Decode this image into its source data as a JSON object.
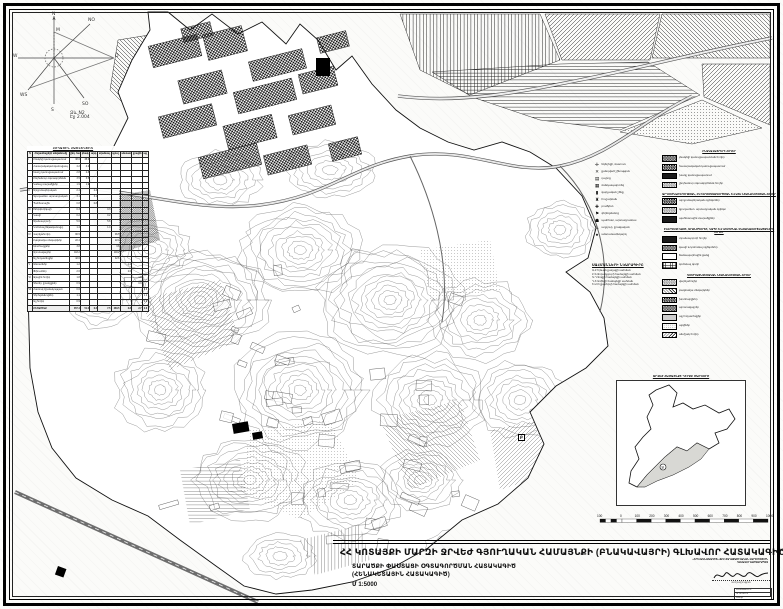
{
  "page": {
    "bg": "#fbfbf9",
    "ink": "#111111",
    "accent_gray": "#cfcfcf"
  },
  "compass": {
    "labels": {
      "n": "N",
      "m": "M",
      "no": "NO",
      "o": "O",
      "w": "W",
      "ws": "WS",
      "s": "S",
      "so": "SO"
    },
    "note_line1": "Ձև N2",
    "note_line2": "Էջ 2.004"
  },
  "land_table": {
    "title": "ՀՈՂԱՅԻՆ ՀԱՇՎԵԿՇԻՌ",
    "col_headers": [
      "N",
      "Հողատեսքերի անվանումը",
      "ընդ. հա",
      "բնակ.",
      "արդ.",
      "տրանսպ.",
      "գյուղ.",
      "անտառ",
      "ջրային",
      "այլ"
    ],
    "rows": [
      [
        "I",
        "Բնակելի կառուցապատում",
        "38.6",
        "38.6",
        "",
        "",
        "",
        "",
        "",
        ""
      ],
      [
        "",
        "Հասարակական կառուցապ.",
        "4.2",
        "4.2",
        "",
        "",
        "",
        "",
        "",
        ""
      ],
      [
        "",
        "Խառը կառուցապատում",
        "2.8",
        "2.8",
        "",
        "",
        "",
        "",
        "",
        ""
      ],
      [
        "",
        "Ընդհանուր օգտագործման",
        "3.5",
        "3.5",
        "",
        "",
        "",
        "",
        "",
        ""
      ],
      [
        "",
        "Կանաչ տարածքներ",
        "1.9",
        "1.9",
        "",
        "",
        "",
        "",
        "",
        ""
      ],
      [
        "II",
        "Արդյունաբերական",
        "2.4",
        "",
        "2.4",
        "",
        "",
        "",
        "",
        ""
      ],
      [
        "",
        "Գյուղատնտ. արտադրական",
        "3.1",
        "",
        "3.1",
        "",
        "",
        "",
        "",
        ""
      ],
      [
        "",
        "Պահեստային",
        "0.8",
        "",
        "0.8",
        "",
        "",
        "",
        "",
        ""
      ],
      [
        "III",
        "Էներգետիկայի",
        "0.3",
        "",
        "",
        "0.3",
        "",
        "",
        "",
        ""
      ],
      [
        "",
        "Կապի",
        "0.2",
        "",
        "",
        "0.2",
        "",
        "",
        "",
        ""
      ],
      [
        "",
        "Տրանսպորտի",
        "5.6",
        "",
        "",
        "5.6",
        "",
        "",
        "",
        ""
      ],
      [
        "",
        "Կոմունալ ենթակառուցվ.",
        "1.4",
        "",
        "",
        "1.4",
        "",
        "",
        "",
        ""
      ],
      [
        "IV",
        "Վարելահողեր",
        "96.5",
        "",
        "",
        "",
        "96.5",
        "",
        "",
        ""
      ],
      [
        "",
        "Բազմամյա տնկարկներ",
        "22.4",
        "",
        "",
        "",
        "22.4",
        "",
        "",
        ""
      ],
      [
        "",
        "Խոտհարքներ",
        "3.8",
        "",
        "",
        "",
        "3.8",
        "",
        "",
        ""
      ],
      [
        "",
        "Արոտավայրեր",
        "118.2",
        "",
        "",
        "",
        "118.2",
        "",
        "",
        ""
      ],
      [
        "",
        "Այլ հողատեսքեր",
        "42.6",
        "",
        "",
        "",
        "42.6",
        "",
        "",
        ""
      ],
      [
        "V",
        "Անտառներ",
        "1.2",
        "",
        "",
        "",
        "",
        "1.2",
        "",
        ""
      ],
      [
        "",
        "Թփուտներ",
        "2.6",
        "",
        "",
        "",
        "",
        "2.6",
        "",
        ""
      ],
      [
        "VI",
        "Ջրային հողեր",
        "1.8",
        "",
        "",
        "",
        "",
        "",
        "1.8",
        ""
      ],
      [
        "",
        "Գետեր, ջրանցքներ",
        "0.9",
        "",
        "",
        "",
        "",
        "",
        "0.9",
        ""
      ],
      [
        "VII",
        "Հատուկ նշանակության",
        "0.6",
        "",
        "",
        "",
        "",
        "",
        "",
        "0.6"
      ],
      [
        "",
        "Գերեզմանոցներ",
        "1.1",
        "",
        "",
        "",
        "",
        "",
        "",
        "1.1"
      ],
      [
        "",
        "Այլ հողեր",
        "0.9",
        "",
        "",
        "",
        "",
        "",
        "",
        "0.9"
      ]
    ],
    "total_row": [
      "",
      "ԸՆԴԱՄԵՆԸ",
      "357.4",
      "51.0",
      "6.3",
      "7.5",
      "283.5",
      "3.8",
      "2.7",
      "2.6"
    ]
  },
  "symbols": {
    "items": [
      {
        "glyph": "✛",
        "label": "եկեղեցի, մատուռ"
      },
      {
        "glyph": "✕",
        "label": "քանդված շինություն"
      },
      {
        "glyph": "▤",
        "label": "դպրոց"
      },
      {
        "glyph": "▦",
        "label": "մանկապարտեզ"
      },
      {
        "glyph": "▮",
        "label": "վարչական շենք"
      },
      {
        "glyph": "♜",
        "label": "հուշարձան"
      },
      {
        "glyph": "✚",
        "label": "բուժկետ"
      },
      {
        "glyph": "⚑",
        "label": "գերեզմանոց"
      },
      {
        "glyph": "☗",
        "label": "պահեստ, արտադրամաս"
      },
      {
        "glyph": "♨",
        "label": "աղբյուր, ջրավազան"
      },
      {
        "glyph": "♠",
        "label": "անտառատնկարկ"
      }
    ]
  },
  "boundaries": {
    "title": "ՍԱՀՄԱՆՆԵՐԻ ՆԿԱՐԱԳԻՐԸ",
    "lines": [
      "Ա-Բ Երևան քաղաքի սահման",
      "Բ-Գ Ձորաղբյուրի համայնքի սահման",
      "Գ-Դ Զովքի համայնքի սահման",
      "Դ-Ե Առինջի համայնքի սահման",
      "Ե-Ա Ողջաբերդի համայնքի սահման"
    ]
  },
  "legend_right": {
    "sections": [
      {
        "title": "ԲՆԱԿԱՎԱՅՐԵՐԻ ՀՈՂԵՐ",
        "items": [
          {
            "pattern": "sw-check-dense",
            "label": "բնակելի կառուցապատման հողեր"
          },
          {
            "pattern": "sw-check",
            "label": "հասարակական կառուցապատում"
          },
          {
            "pattern": "sw-solid-dark",
            "label": "խառը կառուցապատում"
          },
          {
            "pattern": "sw-check-light",
            "label": "ընդհանուր օգտագործման հողեր"
          }
        ]
      },
      {
        "title": "ԱՐԴՅՈՒՆԱԲԵՐՈՒԹՅԱՆ, ԸՆԴԵՐՔՕԳՏԱԳՈՐԾՄԱՆ ԵՎ ԱՅԼ ՆՇԱՆԱԿՈՒԹՅԱՆ ՀՈՂԵՐ",
        "items": [
          {
            "pattern": "sw-check",
            "label": "արդյունաբերական օբյեկտներ"
          },
          {
            "pattern": "sw-check-light",
            "label": "գյուղատնտ. արտադրական օբյեկտ"
          },
          {
            "pattern": "sw-solid-dark",
            "label": "պահեստային տարածքներ"
          }
        ]
      },
      {
        "title": "ԷՆԵՐԳԵՏԻԿԱՅԻ, ՏՐԱՆՍՊՈՐՏԻ, ԿԱՊԻ ԵՎ ԿՈՄՈՒՆԱԼ ԵՆԹԱԿԱՌՈՒՑՎԱԾՔՆԵՐԻ ՀՈՂԵՐ",
        "items": [
          {
            "pattern": "sw-solid-dark",
            "label": "տրանսպորտի հողեր"
          },
          {
            "pattern": "sw-check-dense",
            "label": "կապի և կոմունալ օբյեկտներ"
          },
          {
            "pattern": "sw-light",
            "label": "ճանապարհային ցանց"
          },
          {
            "pattern": "sw-grid",
            "label": "կոմունալ գոտի"
          }
        ]
      },
      {
        "title": "ԳՅՈՒՂԱՏՆՏԵՍԱԿԱՆ ՆՇԱՆԱԿՈՒԹՅԱՆ ՀՈՂԵՐ",
        "items": [
          {
            "pattern": "sw-check-light",
            "label": "վարելահողեր"
          },
          {
            "pattern": "sw-hatch",
            "label": "բազմամյա տնկարկներ"
          },
          {
            "pattern": "sw-check",
            "label": "խոտհարքներ"
          },
          {
            "pattern": "sw-check-dense",
            "label": "արոտավայրեր"
          },
          {
            "pattern": "sw-gray",
            "label": "այլ հողատեսքեր"
          },
          {
            "pattern": "sw-dots",
            "label": "այգիներ"
          },
          {
            "pattern": "sw-hatch2",
            "label": "անմշակ հողեր"
          }
        ]
      }
    ]
  },
  "inset": {
    "title": "ՋՐՎԵԺ ՀԱՄԱՅՆՔԻ ԴԻՐՔԸ ՄԱՐԶՈՒՄ",
    "marker": "Ջ"
  },
  "scalebar": {
    "pre_label": "100",
    "labels": [
      "0",
      "100",
      "200",
      "300",
      "400",
      "500",
      "600",
      "700",
      "800",
      "900",
      "1000"
    ]
  },
  "map": {
    "marker_b": "Բ"
  },
  "title_block": {
    "main": "ՀՀ ԿՈՏԱՅՔԻ ՄԱՐԶԻ ՋՐՎԵԺ ԳՅՈՒՂԱԿԱՆ ՀԱՄԱՅՆՔԻ (ԲՆԱԿԱՎԱՅՐԻ) ԳԼԽԱՎՈՐ ՀԱՏԱԿԱԳԻԾ",
    "sub1": "ՏԱՐԱԾՔԻ ՓԱՍՏԱՑԻ ՕԳՏԱԳՈՐԾՄԱՆ ՀԱՏԱԿԱԳԻԾ",
    "sub2": "(ՀԵՆԱԿԵՏԱՅԻՆ ՀԱՏԱԿԱԳԻԾ)",
    "scale": "Մ 1:5000",
    "org_line1": "«ԵՐԵՎԱՆՆԱԽԱԳԻԾ» ՓԲԸ ՔԱՂԱՔԱՇԻՆԱԿԱՆ ՎԱՐՉՈՒԹՅՈՒՆ",
    "org_line2": "ԳԼԽԱՎՈՐ ՃԱՐՏԱՐԱՊԵՏ",
    "sign_caption": "ստորագրություն",
    "stamp_line1": "ՀԱՍՏԱՏՎԱԾ Է",
    "stamp_line2": "ՈՐՈՇՈՒՄ N",
    "stamp_line3": "2004 թ."
  }
}
